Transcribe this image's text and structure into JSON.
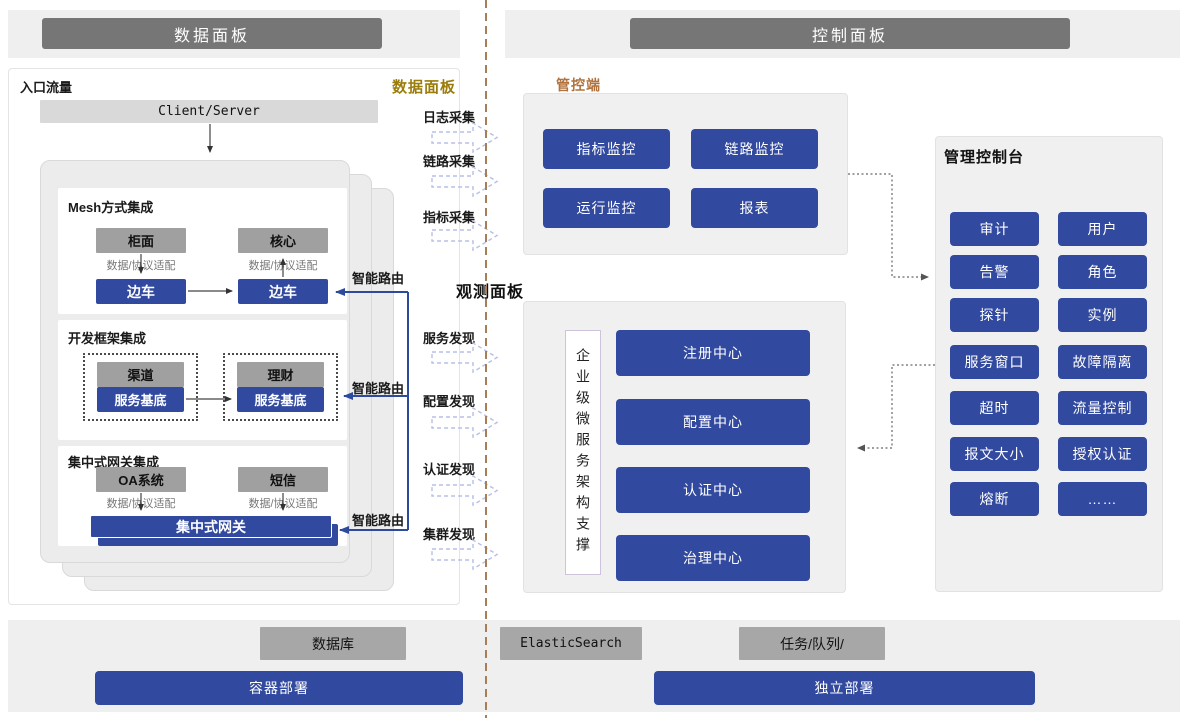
{
  "colors": {
    "accent_blue": "#31499E",
    "route_blue": "#2e4a9d",
    "header_gray": "#767676",
    "box_gray": "#a0a0a0",
    "divider_brown": "#a97e57",
    "gold_label": "#9a7d0a",
    "terracotta_label": "#b0713c"
  },
  "headers": {
    "data_plane": "数据面板",
    "control_plane": "控制面板"
  },
  "data_panel": {
    "entry_label": "入口流量",
    "corner_badge": "数据面板",
    "client_server": "Client/Server",
    "adapt_label": "数据/协议适配",
    "smart_route": "智能路由",
    "mesh": {
      "title": "Mesh方式集成",
      "box1": "柜面",
      "box2": "核心",
      "sidecar": "边车"
    },
    "framework": {
      "title": "开发框架集成",
      "box1": "渠道",
      "box2": "理财",
      "base": "服务基底"
    },
    "gateway": {
      "title": "集中式网关集成",
      "box1": "OA系统",
      "box2": "短信",
      "bar": "集中式网关"
    }
  },
  "middle": {
    "collect": [
      "日志采集",
      "链路采集",
      "指标采集"
    ],
    "observe_title": "观测面板",
    "discover": [
      "服务发现",
      "配置发现",
      "认证发现",
      "集群发现"
    ]
  },
  "control_panel": {
    "label": "管控端",
    "monitor_buttons": [
      "指标监控",
      "链路监控",
      "运行监控",
      "报表"
    ],
    "observe": {
      "vertical_label": "企业级微服务架构支撑",
      "centers": [
        "注册中心",
        "配置中心",
        "认证中心",
        "治理中心"
      ]
    },
    "console": {
      "title": "管理控制台",
      "buttons": [
        "审计",
        "用户",
        "告警",
        "角色",
        "探针",
        "实例",
        "服务窗口",
        "故障隔离",
        "超时",
        "流量控制",
        "报文大小",
        "授权认证",
        "熔断",
        "……"
      ]
    }
  },
  "bottom": {
    "database": "数据库",
    "elastic": "ElasticSearch",
    "queue": "任务/队列/",
    "container": "容器部署",
    "standalone": "独立部署"
  }
}
